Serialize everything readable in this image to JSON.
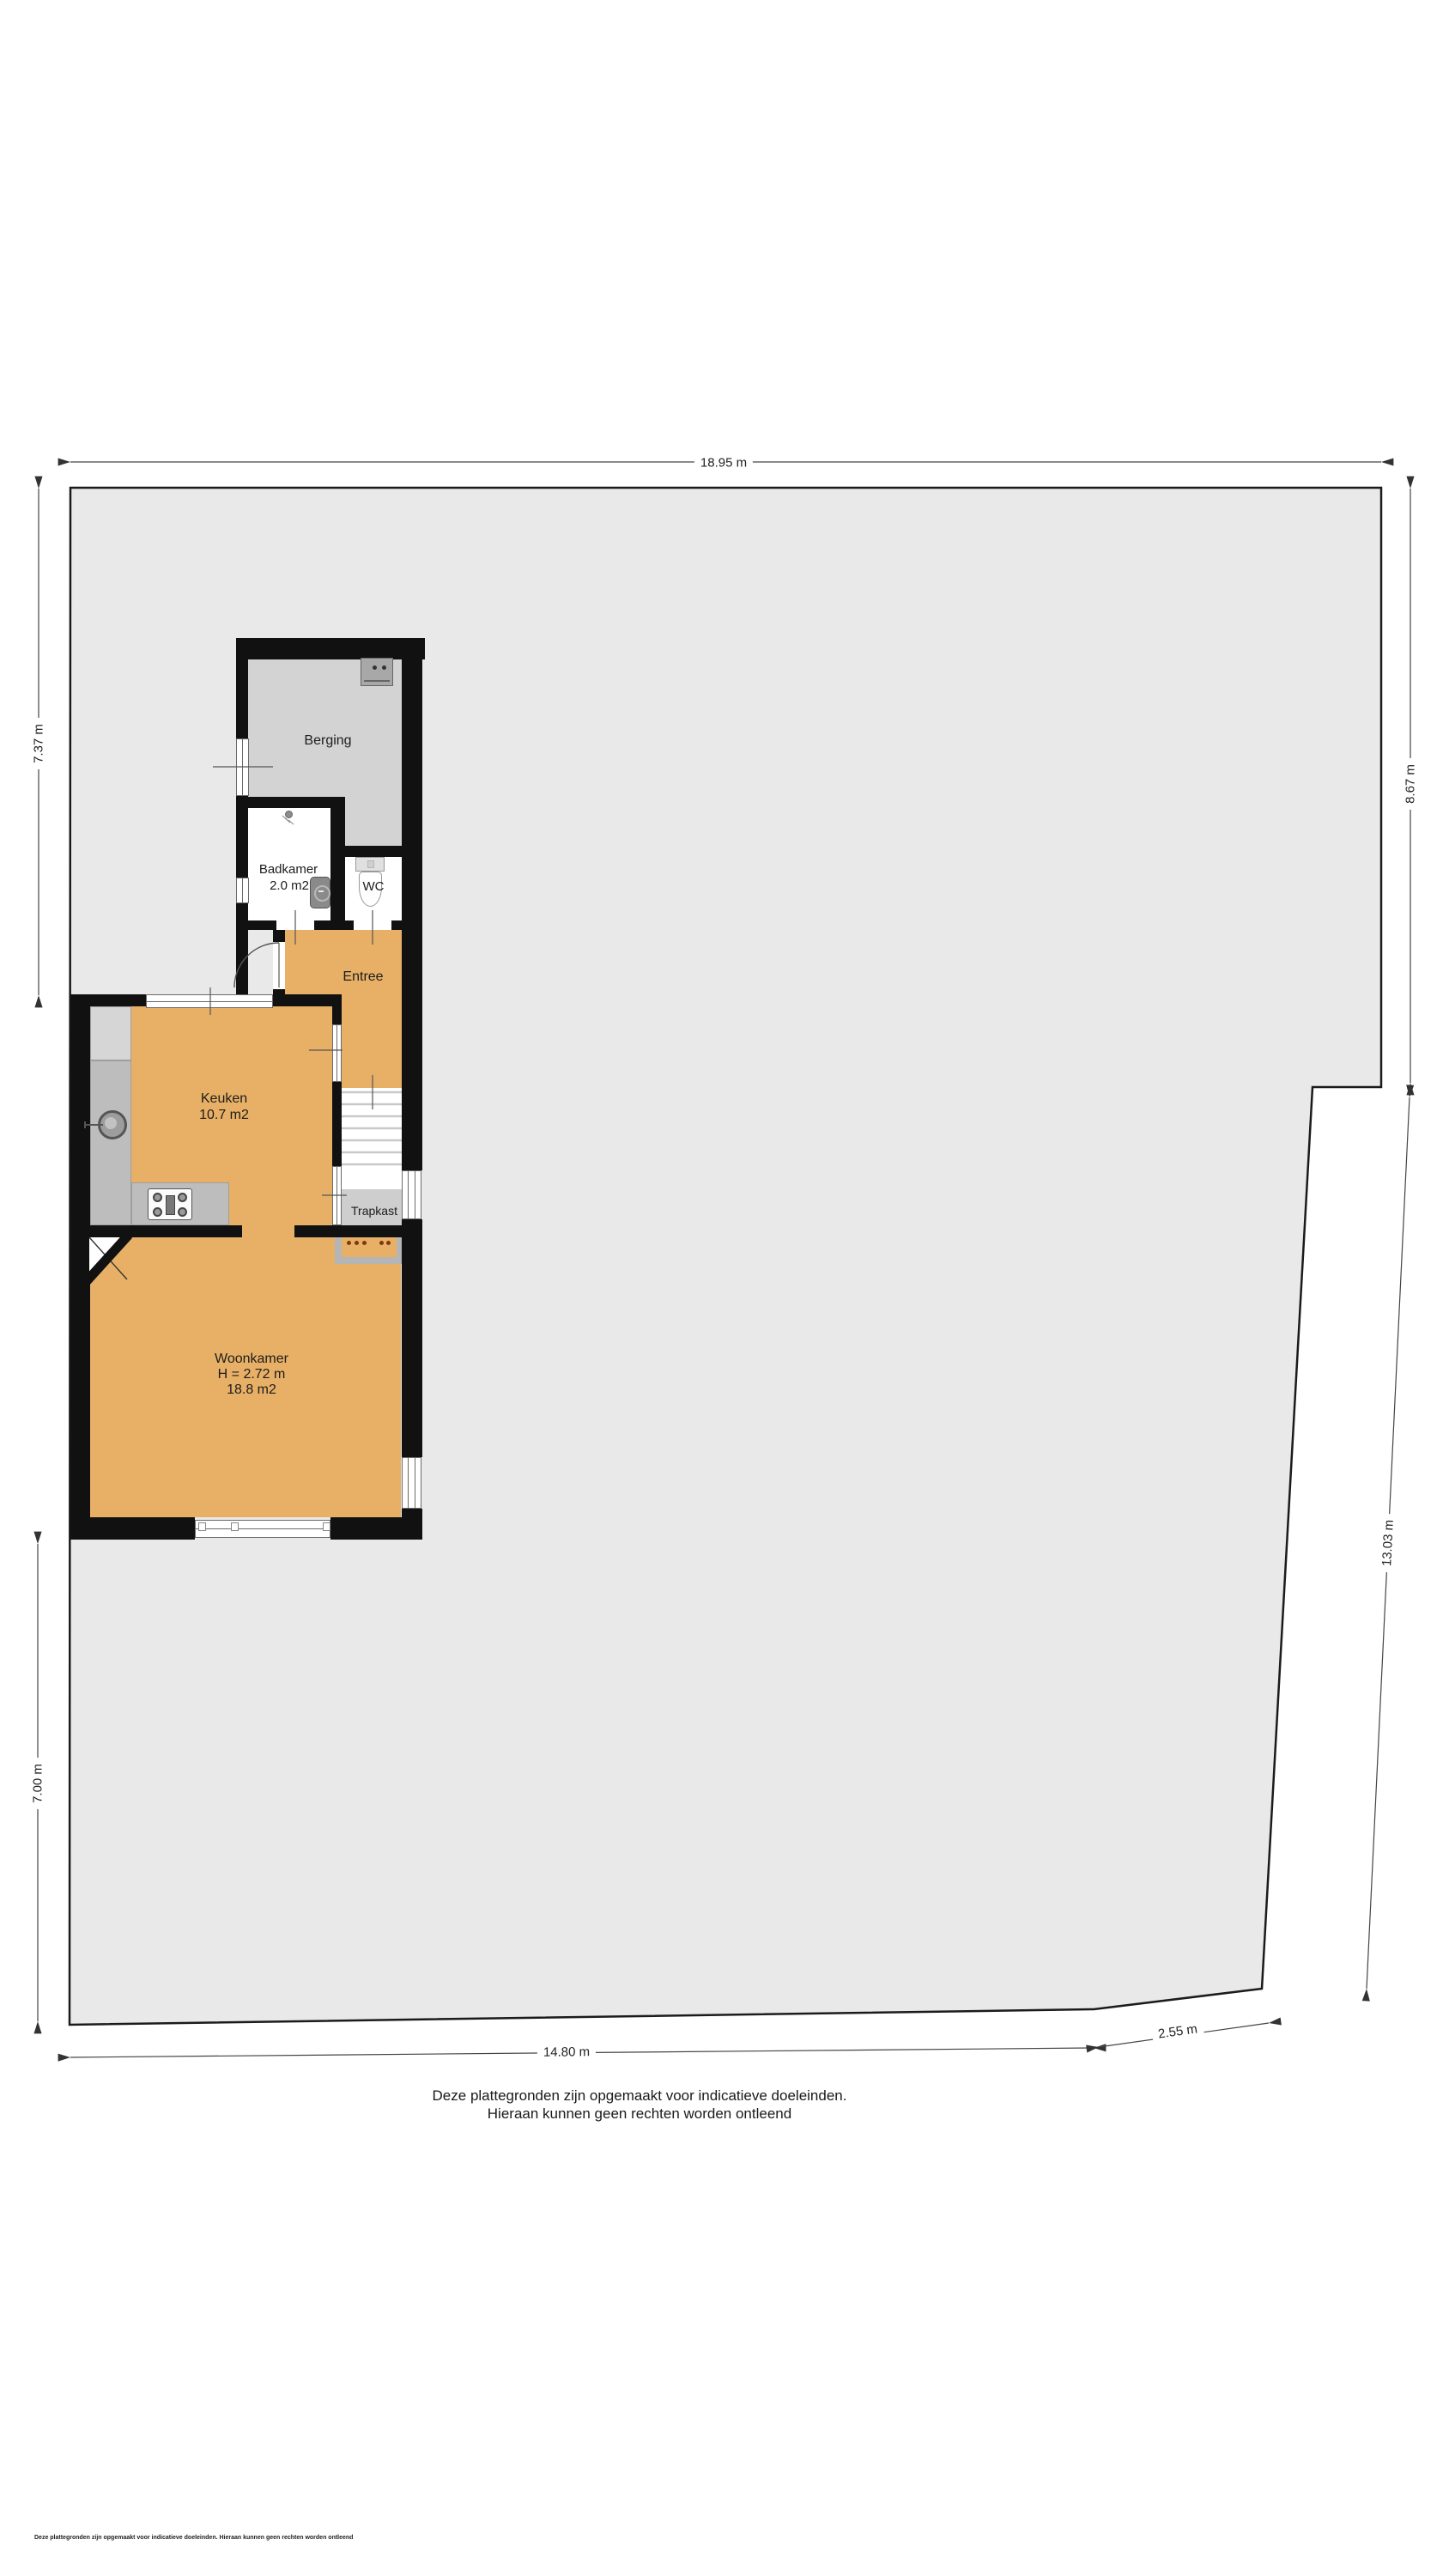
{
  "document": {
    "type": "floor-plan-with-plot",
    "footer_note": "Deze plattegronden zijn opgemaakt voor indicatieve doeleinden. Hieraan kunnen geen rechten worden ontleend"
  },
  "rooms": {
    "berging": {
      "label": "Berging"
    },
    "badkamer": {
      "label": "Badkamer",
      "area": "2.0 m2"
    },
    "wc": {
      "label": "WC"
    },
    "entree": {
      "label": "Entree"
    },
    "keuken": {
      "label": "Keuken",
      "area": "10.7 m2"
    },
    "trapkast": {
      "label": "Trapkast"
    },
    "woonkamer": {
      "label": "Woonkamer",
      "height": "H = 2.72 m",
      "area": "18.8 m2"
    }
  },
  "dimensions": {
    "top": "18.95 m",
    "left_upper": "7.37 m",
    "left_lower": "7.00 m",
    "right_upper": "8.67 m",
    "right_lower": "13.03 m",
    "bottom": "14.80 m",
    "bottom_right": "2.55 m"
  },
  "disclaimer": {
    "line1": "Deze plattegronden zijn opgemaakt voor indicatieve doeleinden.",
    "line2": "Hieraan kunnen geen rechten worden ontleend"
  },
  "icons": [
    "washing-machine-icon",
    "dryer-icon",
    "shower-icon",
    "toilet-icon",
    "sink-icon",
    "stove-icon",
    "radiator-icon",
    "stairs-icon",
    "door-swing-icon"
  ],
  "colors": {
    "plot_fill": "#e9e9e9",
    "plot_stroke": "#1b1b1b",
    "wall": "#111111",
    "floor_living": "#e8b066",
    "floor_storage": "#d3d3d3",
    "counter": "#bdbdbd",
    "radiator_dots": "#7a3a12",
    "dimension_line": "#333333"
  }
}
